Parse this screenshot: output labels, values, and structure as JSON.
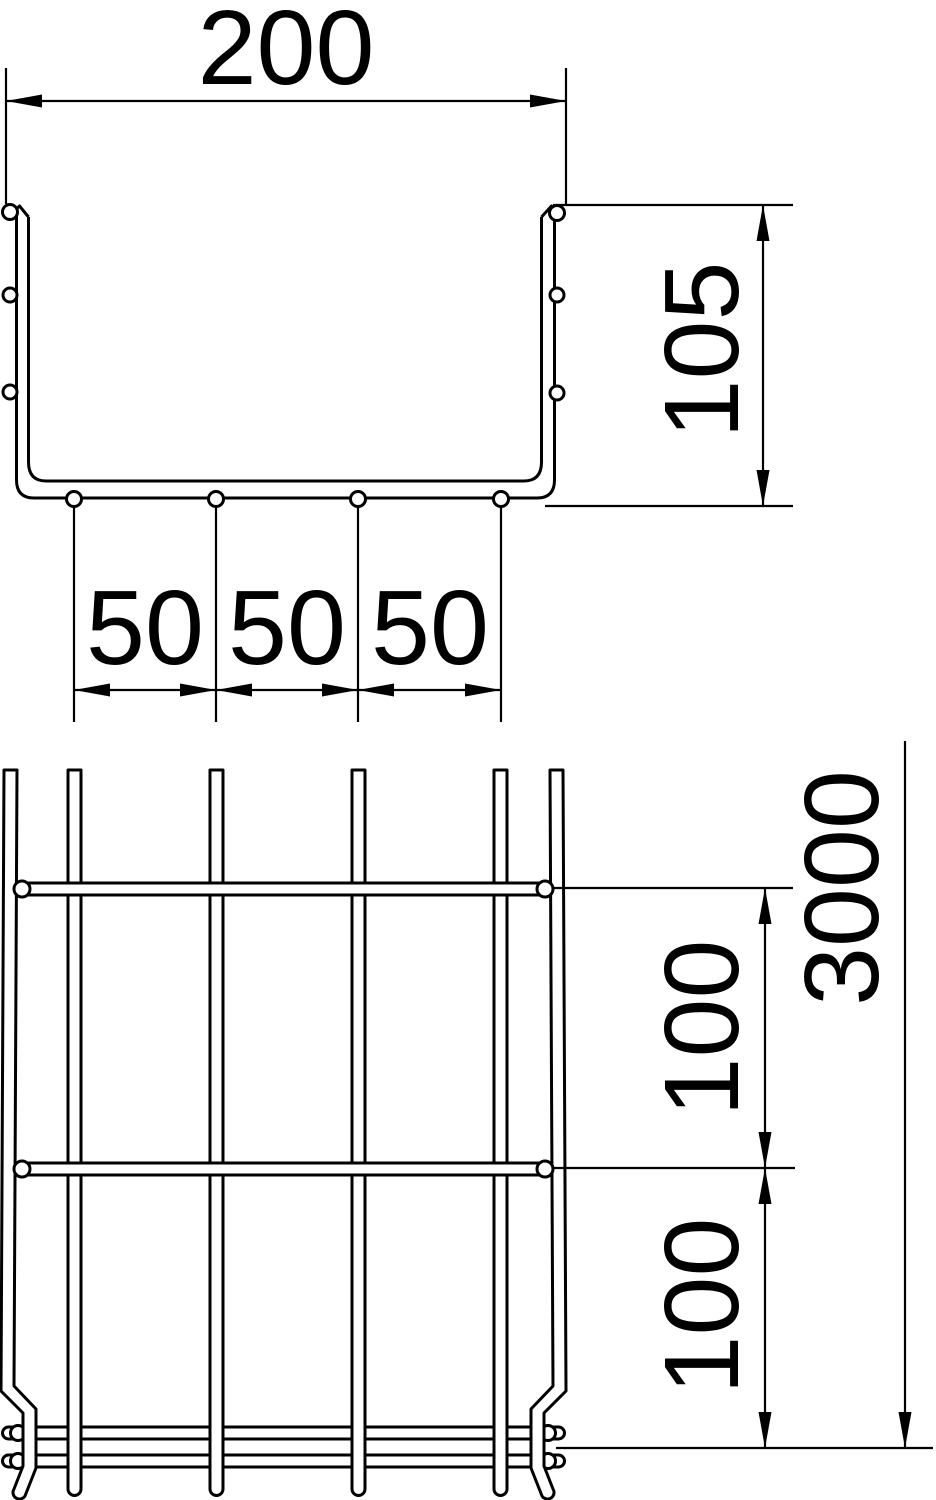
{
  "page": {
    "background": "#ffffff",
    "stroke_color": "#000000",
    "kind": "technical dimension drawing of wire mesh cable tray"
  },
  "drawing": {
    "views": {
      "cross_section": {
        "width_label": "200",
        "height_label": "105",
        "spacing_labels": [
          "50",
          "50",
          "50"
        ]
      },
      "side_view": {
        "spacing_top_label": "100",
        "spacing_bottom_label": "100",
        "length_label": "3000"
      }
    }
  }
}
